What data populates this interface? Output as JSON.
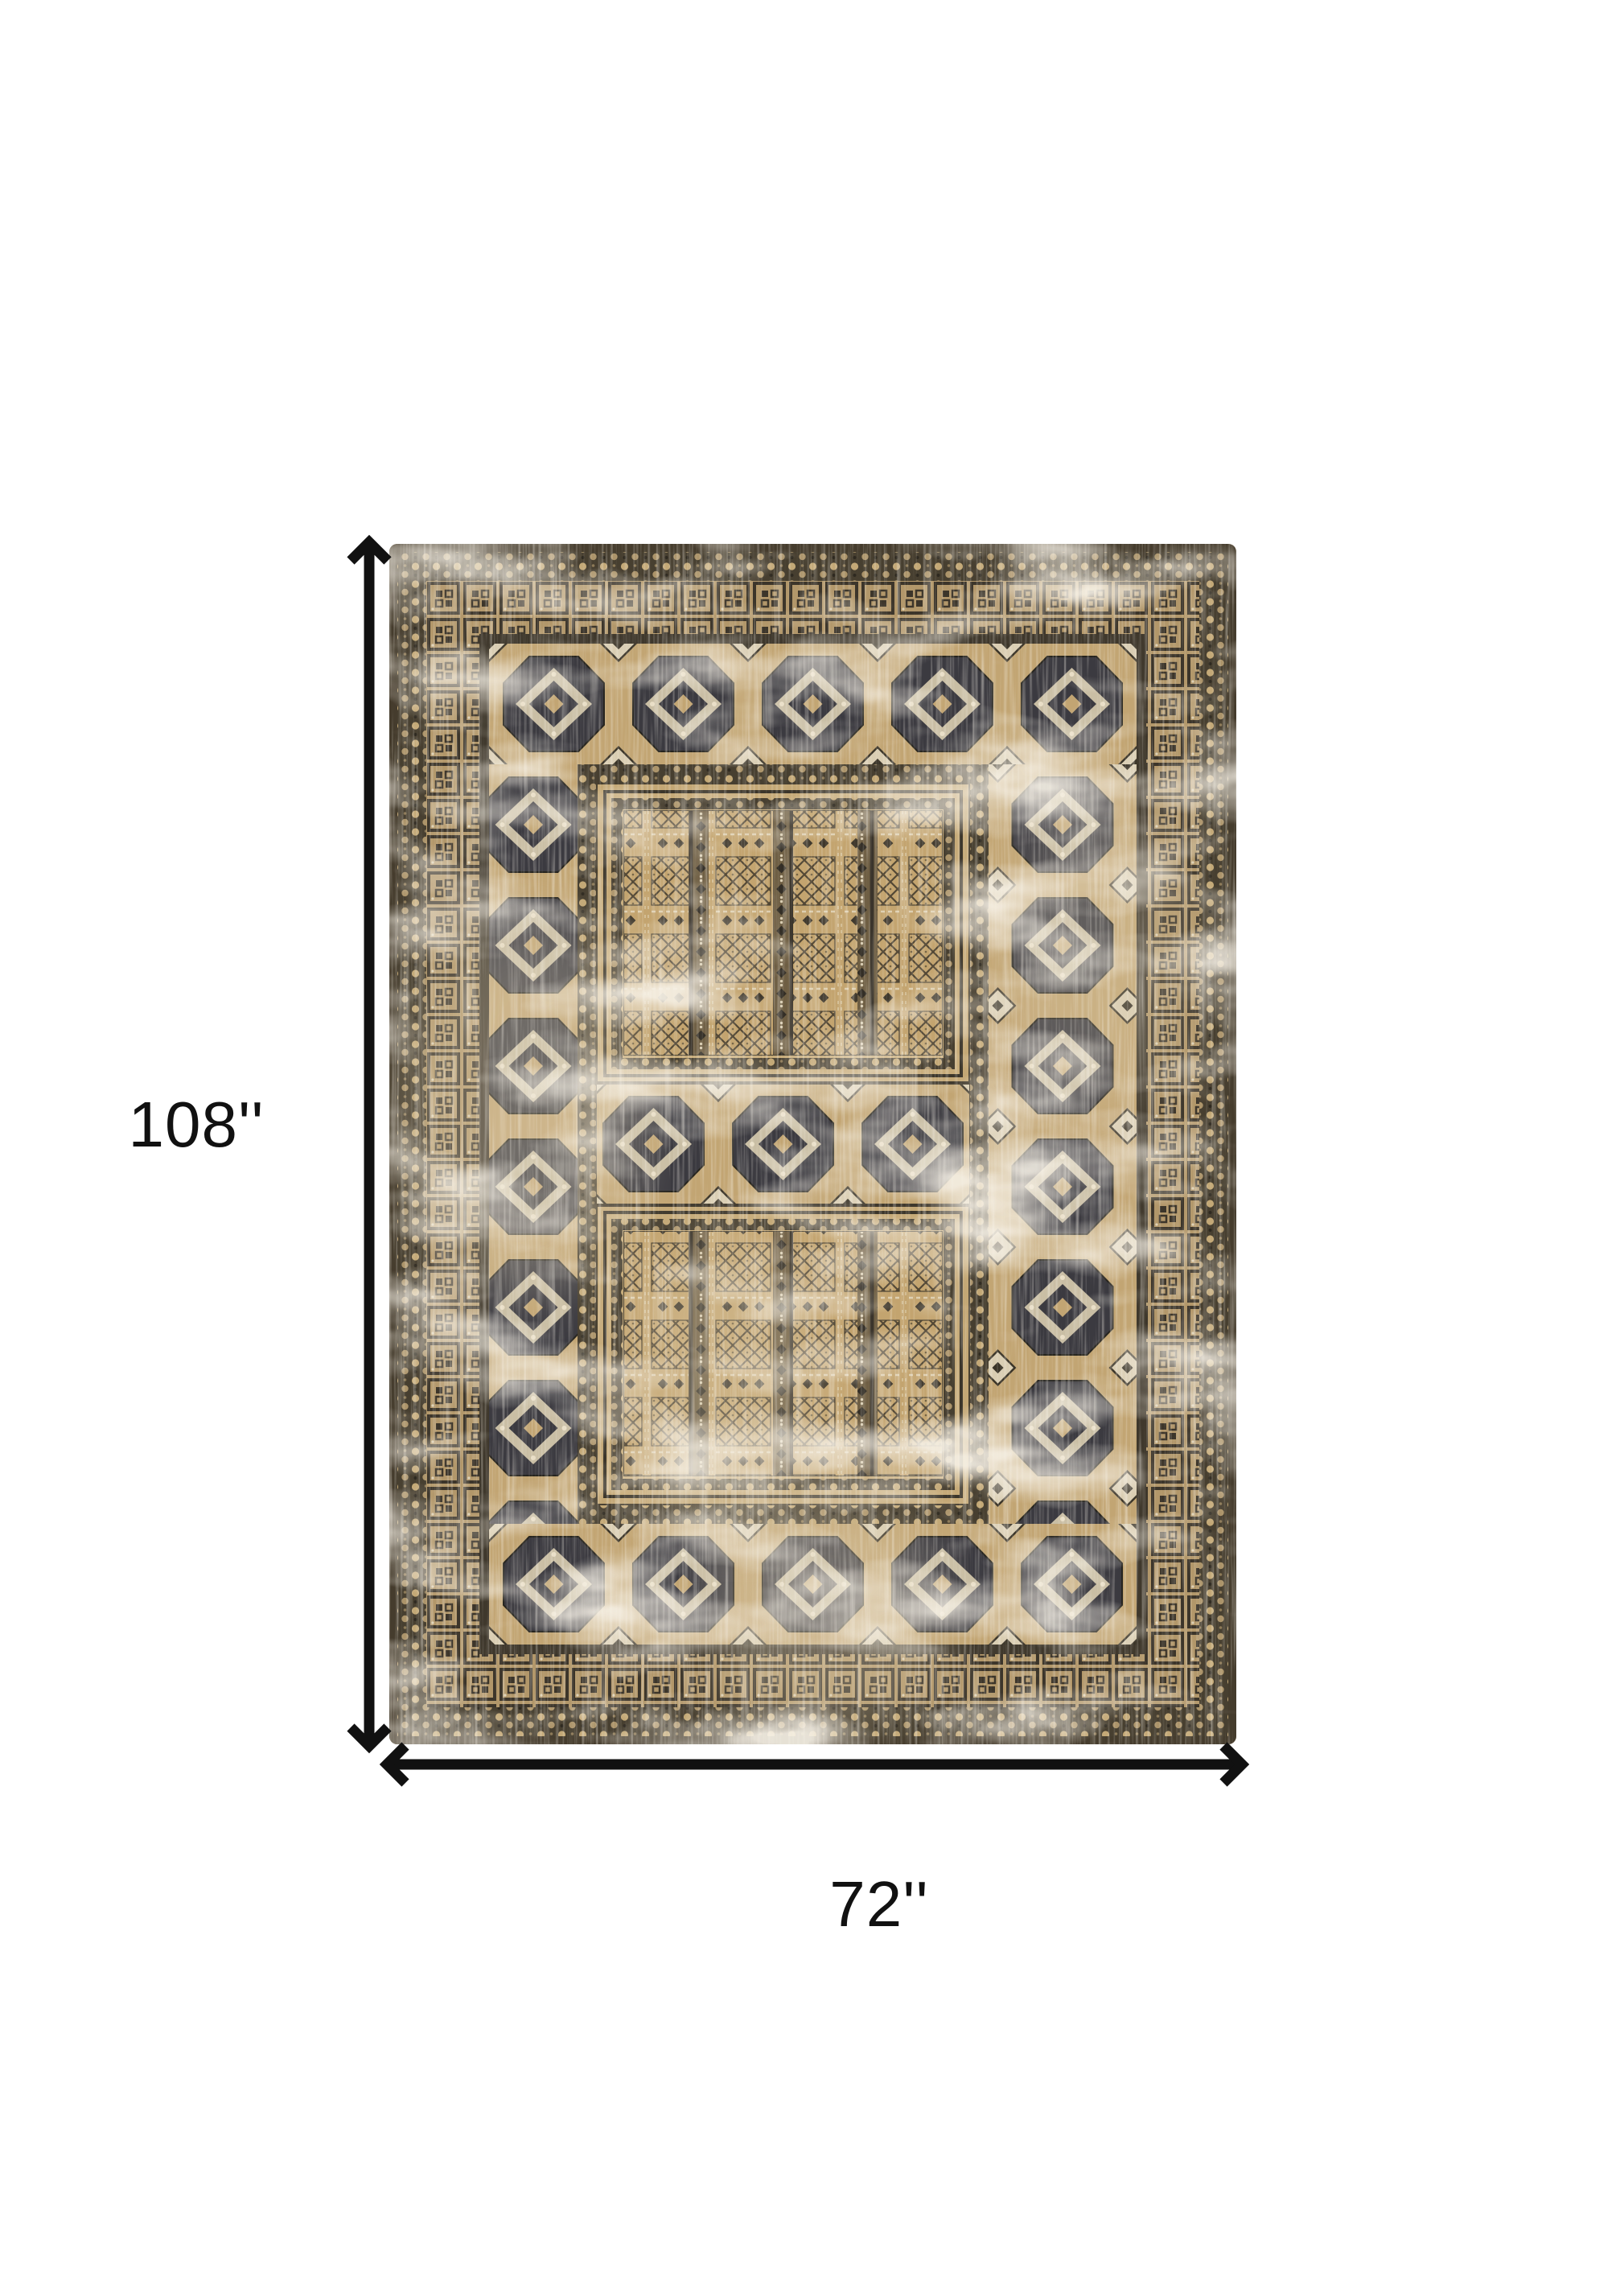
{
  "page": {
    "background_color": "#ffffff"
  },
  "diagram": {
    "height_label": "108''",
    "width_label": "72''",
    "dimension_color": "#111111"
  },
  "rug": {
    "style_note": "distressed vintage oriental rug with medallion borders and two striped panels",
    "colors": {
      "base_tan": "#bfa274",
      "field_tan": "#c3a775",
      "charcoal": "#3b3a40",
      "dark_brown": "#473f30",
      "cream": "#ddd1b6",
      "guard_brown": "#6e5e43"
    }
  }
}
